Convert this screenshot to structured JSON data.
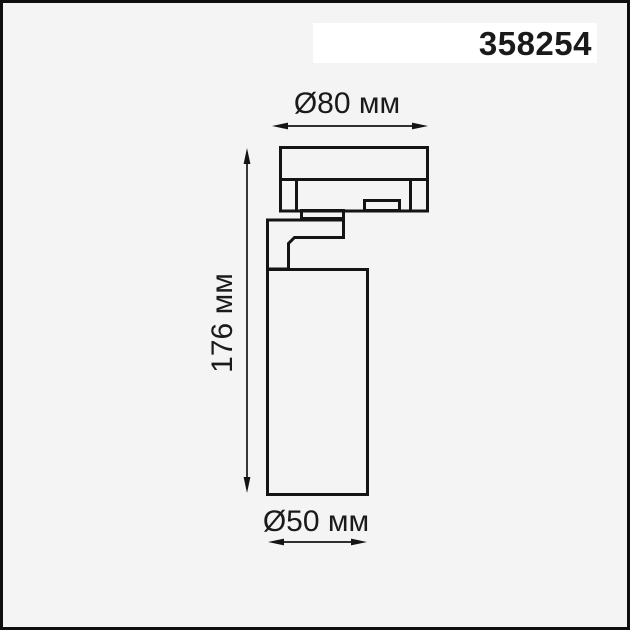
{
  "theme": {
    "bg": "#f4f4f5",
    "line": "#141414",
    "text": "#1a1a1a",
    "codebox": "#ffffff",
    "frame": "#0f0f0f"
  },
  "product": {
    "code": "358254"
  },
  "drawing": {
    "type": "technical-dimension-diagram",
    "labels": {
      "top_diameter": "Ø80 мм",
      "height": "176 мм",
      "bottom_diameter": "Ø50 мм"
    }
  }
}
